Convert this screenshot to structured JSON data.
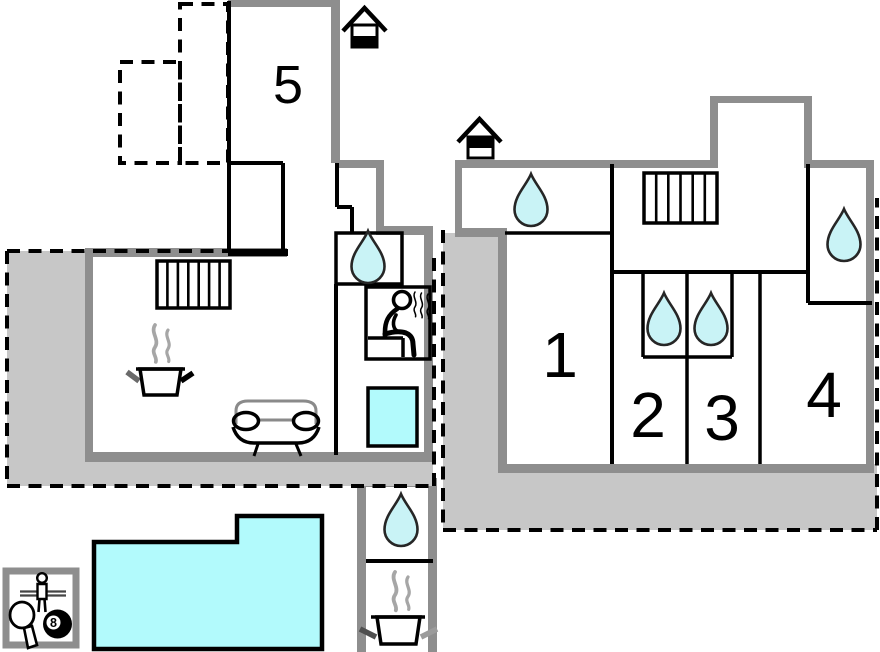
{
  "colors": {
    "wall_gray": "#8e8e8e",
    "terrace_gray": "#c7c7c7",
    "terrace_light": "#e9e9e9",
    "water_blue": "#c9f3f6",
    "pool_blue": "#b2fafc",
    "steam_gray": "#a6a6a6",
    "line_black": "#000000"
  },
  "labels": {
    "room1": "1",
    "room2": "2",
    "room3": "3",
    "room4": "4",
    "room5": "5",
    "eight_ball": "8"
  },
  "plan": {
    "ground_floor": {
      "level_icon": "house-lower-half-filled",
      "rooms": [
        "5"
      ],
      "features": [
        "dashed-terrace-light",
        "dashed-terrace-gray",
        "hallway",
        "stairs",
        "kitchen-pot-with-steam",
        "sofa",
        "bathroom-water-drop",
        "sauna",
        "hot-tub",
        "wraparound-terrace"
      ]
    },
    "upper_floor": {
      "level_icon": "house-upper-half-filled",
      "rooms": [
        "1",
        "2",
        "3",
        "4"
      ],
      "features": [
        "bathroom-water-drop-top-left",
        "stairs",
        "ensuite-drop-room2",
        "ensuite-drop-room3",
        "bathroom-water-drop-room4",
        "wraparound-terrace"
      ]
    },
    "outdoor": {
      "pool": "swimming-pool",
      "game_room_icons": [
        "foosball-player",
        "table-tennis-paddle",
        "billiard-8-ball"
      ],
      "pool_house": [
        "shower-water-drop",
        "kitchen-pot-with-steam"
      ]
    }
  }
}
